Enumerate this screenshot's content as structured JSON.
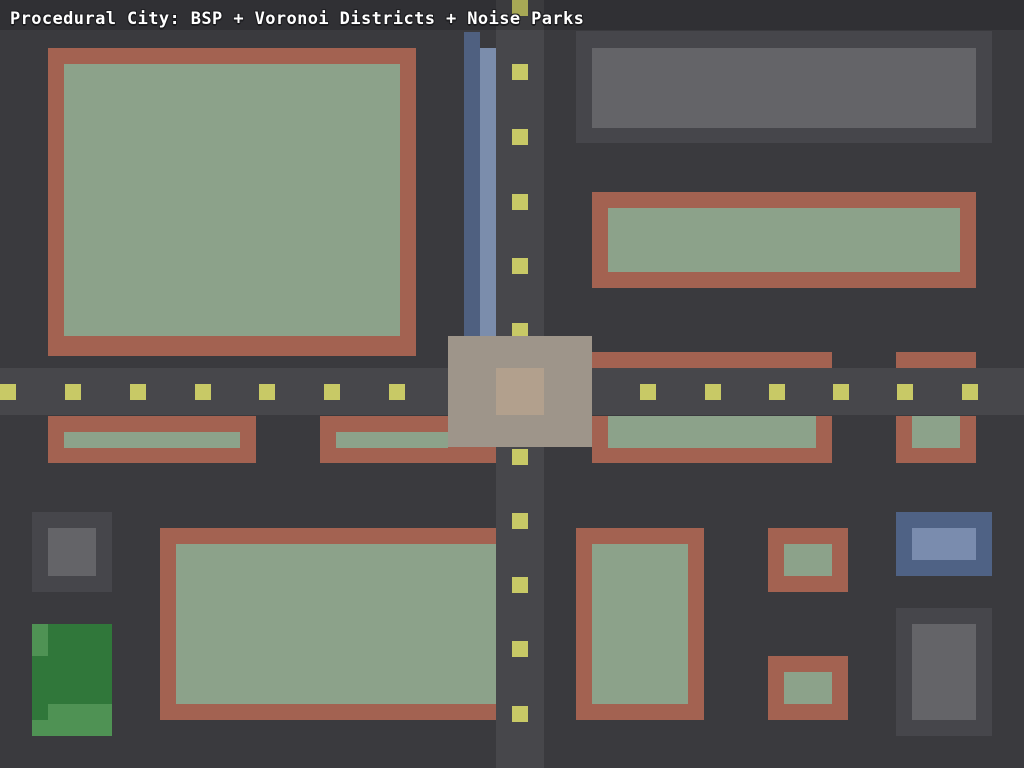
{
  "title": "Procedural City: BSP + Voronoi Districts + Noise Parks",
  "canvas": {
    "width": 1024,
    "height": 768,
    "background": "#3A3A3E"
  },
  "palette": {
    "road": "#47474B",
    "dash": "#C8C966",
    "brick": "#A36251",
    "yard": "#8CA28A",
    "gray_outer": "#46464B",
    "gray_inner": "#646468",
    "water_dark": "#4F6080",
    "water_light": "#7B8DAC",
    "blue_outer": "#4F6285",
    "blue_inner": "#7A8CAE",
    "park_dark": "#30773A",
    "park_light": "#4F9254",
    "pad_outer": "#9E958A",
    "pad_inner": "#B2A08D"
  },
  "roads": {
    "vertical": [
      496,
      0,
      48,
      768
    ],
    "horizontal": [
      0,
      368,
      1024,
      47
    ]
  },
  "lane_dashes": {
    "size": 16,
    "horizontal_y": 384,
    "horizontal_x": [
      0,
      65,
      130,
      195,
      259,
      324,
      389,
      640,
      705,
      769,
      833,
      897,
      962
    ],
    "vertical_x": 512,
    "vertical_y": [
      0,
      64,
      129,
      194,
      258,
      323,
      449,
      513,
      577,
      641,
      706
    ]
  },
  "river": {
    "dark": [
      464,
      32,
      16,
      304
    ],
    "light": [
      480,
      48,
      16,
      288
    ]
  },
  "buildings": [
    {
      "kind": "brick-building",
      "outer": [
        48,
        48,
        368,
        308
      ],
      "outer_color": "brick",
      "inner": [
        64,
        64,
        336,
        272
      ],
      "inner_color": "yard"
    },
    {
      "kind": "office-building",
      "outer": [
        576,
        31,
        416,
        112
      ],
      "outer_color": "gray_outer",
      "inner": [
        592,
        48,
        384,
        80
      ],
      "inner_color": "gray_inner"
    },
    {
      "kind": "brick-building",
      "outer": [
        592,
        192,
        384,
        96
      ],
      "outer_color": "brick",
      "inner": [
        608,
        208,
        352,
        64
      ],
      "inner_color": "yard"
    },
    {
      "kind": "brick-building",
      "outer": [
        592,
        352,
        240,
        16
      ],
      "outer_color": "brick"
    },
    {
      "kind": "brick-building",
      "outer": [
        896,
        352,
        80,
        16
      ],
      "outer_color": "brick"
    },
    {
      "kind": "brick-building",
      "outer": [
        48,
        416,
        208,
        47
      ],
      "outer_color": "brick",
      "inner": [
        64,
        432,
        176,
        16
      ],
      "inner_color": "yard"
    },
    {
      "kind": "brick-building",
      "outer": [
        320,
        416,
        176,
        47
      ],
      "outer_color": "brick",
      "inner": [
        336,
        432,
        112,
        16
      ],
      "inner_color": "yard"
    },
    {
      "kind": "brick-building",
      "outer": [
        592,
        416,
        240,
        47
      ],
      "outer_color": "brick",
      "inner": [
        608,
        416,
        208,
        32
      ],
      "inner_color": "yard"
    },
    {
      "kind": "brick-building",
      "outer": [
        896,
        416,
        80,
        47
      ],
      "outer_color": "brick",
      "inner": [
        912,
        416,
        48,
        32
      ],
      "inner_color": "yard"
    },
    {
      "kind": "office-building",
      "outer": [
        32,
        512,
        80,
        80
      ],
      "outer_color": "gray_outer",
      "inner": [
        48,
        528,
        48,
        48
      ],
      "inner_color": "gray_inner"
    },
    {
      "kind": "brick-building",
      "outer": [
        160,
        528,
        336,
        192
      ],
      "outer_color": "brick",
      "inner": [
        176,
        544,
        320,
        160
      ],
      "inner_color": "yard"
    },
    {
      "kind": "brick-building",
      "outer": [
        576,
        528,
        128,
        192
      ],
      "outer_color": "brick",
      "inner": [
        592,
        544,
        96,
        160
      ],
      "inner_color": "yard"
    },
    {
      "kind": "brick-building",
      "outer": [
        768,
        528,
        80,
        64
      ],
      "outer_color": "brick",
      "inner": [
        784,
        544,
        48,
        32
      ],
      "inner_color": "yard"
    },
    {
      "kind": "blue-building",
      "outer": [
        896,
        512,
        96,
        64
      ],
      "outer_color": "blue_outer",
      "inner": [
        912,
        528,
        64,
        32
      ],
      "inner_color": "blue_inner"
    },
    {
      "kind": "brick-building",
      "outer": [
        768,
        656,
        80,
        64
      ],
      "outer_color": "brick",
      "inner": [
        784,
        672,
        48,
        32
      ],
      "inner_color": "yard"
    },
    {
      "kind": "office-building",
      "outer": [
        896,
        608,
        96,
        128
      ],
      "outer_color": "gray_outer",
      "inner": [
        912,
        624,
        64,
        96
      ],
      "inner_color": "gray_inner"
    }
  ],
  "park": {
    "base": [
      32,
      624,
      80,
      112
    ],
    "base_color": "park_dark",
    "patches": [
      [
        32,
        624,
        16,
        32
      ],
      [
        48,
        704,
        64,
        32
      ],
      [
        32,
        720,
        16,
        16
      ]
    ],
    "patch_color": "park_light"
  },
  "intersection": {
    "pad": [
      448,
      336,
      144,
      111
    ],
    "pad_color": "pad_outer",
    "core": [
      496,
      368,
      48,
      47
    ],
    "core_color": "pad_inner"
  }
}
